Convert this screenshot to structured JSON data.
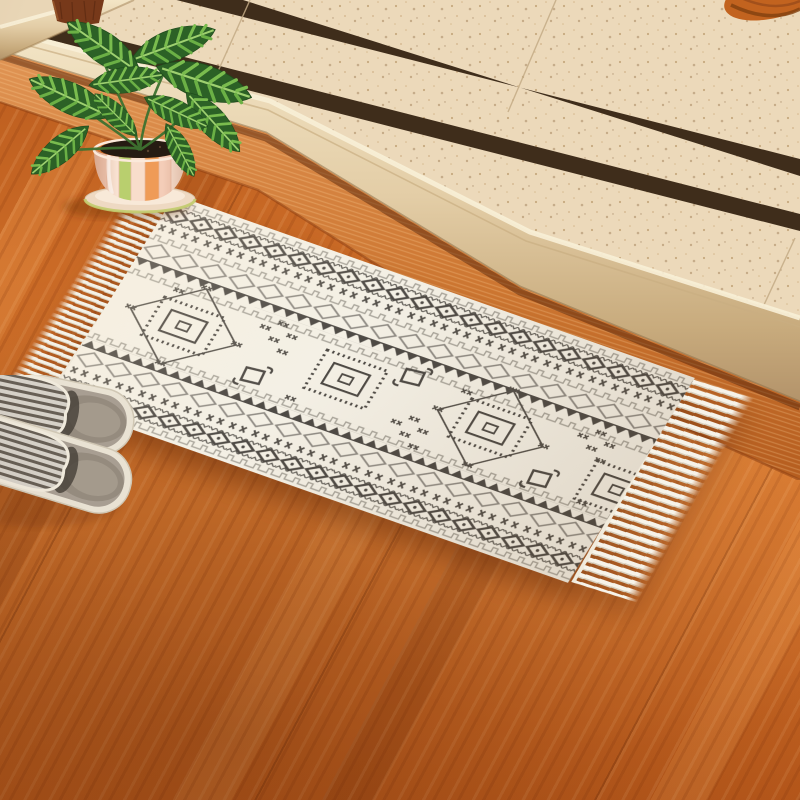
{
  "image": {
    "type": "product-photograph",
    "description": "Cream boho area rug with dark geometric pattern and tassel fringe lying diagonally on an orange wood plank floor beside a beige speckled tile step with two dark brown accent stripes; a zebra-striped calathea plant in a scalloped striped ceramic pot sits at the top left and a pair of gray striped open-toe slippers rests at the left edge.",
    "width_px": 800,
    "height_px": 800
  },
  "palette": {
    "wood_floor": "#c4631f",
    "wood_floor_highlight": "#d98b4a",
    "tile": "#ecd9ba",
    "tile_stripe": "#3f2d1b",
    "rug_base": "#f4f0e5",
    "rug_pattern_dark": "#4e4a45",
    "rug_pattern_light": "#8f8b84",
    "fringe": "#f6f2e8",
    "leaf_dark_green": "#2c6126",
    "leaf_light_green": "#7abc4e",
    "pot_orange": "#ef9b57",
    "pot_green": "#b9cf6e",
    "slipper_stripe_dark": "#675f55",
    "slipper_stripe_light": "#d6d1c8"
  },
  "scene": {
    "floor": {
      "material": "orange-brown wood planks",
      "grain_angle_deg": 28,
      "color": "#c4631f"
    },
    "step": {
      "tile_color": "#ecd9ba",
      "stripe_color": "#3f2d1b",
      "stripe_count": 2,
      "edge": "bullnose",
      "corner_post_color": "#77391a"
    },
    "rug": {
      "background_color": "#f4f0e5",
      "pattern_dark": "#4e4a45",
      "pattern_light": "#8f8b84",
      "fringe_color": "#f6f2e8",
      "rotation_deg": 19.4,
      "motifs": [
        "stepped zigzag",
        "dark diamond chain",
        "cross row",
        "light diamond chain",
        "sawtooth",
        "fringed square medallion",
        "diamond medallion",
        "hook",
        "x cluster"
      ]
    },
    "plant": {
      "species": "calathea",
      "leaf_base": "#2c6126",
      "leaf_stripe": "#7abc4e",
      "vein": "#9ed06f",
      "soil": "#261b12",
      "pot": {
        "stripe_colors": [
          "#f4cdb8",
          "#f9e2d2",
          "#b9cf6e",
          "#f8ddcb",
          "#ef9b57"
        ],
        "saucer": "#eed9c2",
        "saucer_rim": "#c2cc6e"
      }
    },
    "slippers": {
      "pair": true,
      "stripe_dark": "#675f55",
      "stripe_light": "#d6d1c8",
      "sole": "#e9e2d3",
      "footbed": "#a89e92"
    },
    "corner_object": {
      "color": "#c2631f"
    }
  }
}
